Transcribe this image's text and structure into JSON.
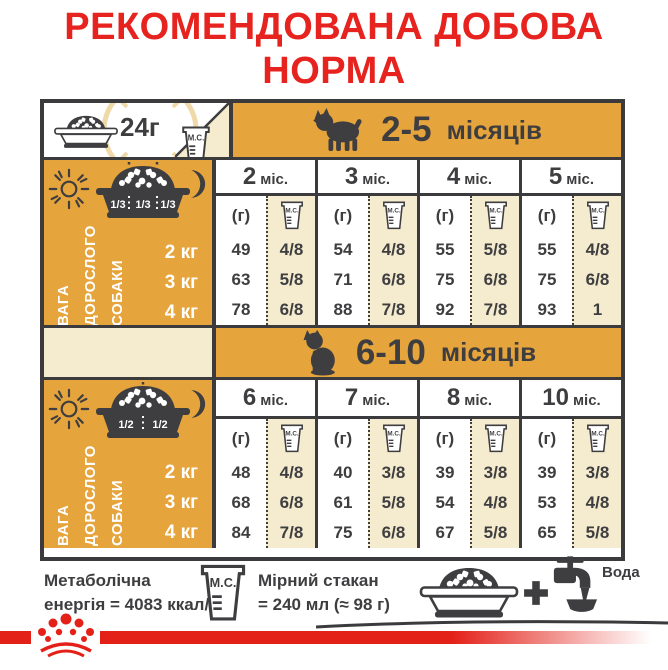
{
  "title": {
    "line1": "РЕКОМЕНДОВАНА ДОБОВА",
    "line2": "НОРМА"
  },
  "daily_amount": "24г",
  "labels": {
    "grams": "(г)",
    "cup_abbr": "М.С.",
    "water": "Вода",
    "plus": "+"
  },
  "sidebar": {
    "weight_lines": [
      "ВАГА",
      "ДОРОСЛОГО",
      "СОБАКИ"
    ],
    "weights": [
      "2 кг",
      "3 кг",
      "4 кг"
    ]
  },
  "sections": [
    {
      "range": "2-5",
      "range_unit": "місяців",
      "portions": [
        "1/3",
        "1/3",
        "1/3"
      ],
      "columns": [
        {
          "num": "2",
          "suffix": "міс.",
          "grams": [
            "49",
            "63",
            "78"
          ],
          "cups": [
            "4/8",
            "5/8",
            "6/8"
          ]
        },
        {
          "num": "3",
          "suffix": "міс.",
          "grams": [
            "54",
            "71",
            "88"
          ],
          "cups": [
            "4/8",
            "6/8",
            "7/8"
          ]
        },
        {
          "num": "4",
          "suffix": "міс.",
          "grams": [
            "55",
            "75",
            "92"
          ],
          "cups": [
            "5/8",
            "6/8",
            "7/8"
          ]
        },
        {
          "num": "5",
          "suffix": "міс.",
          "grams": [
            "55",
            "75",
            "93"
          ],
          "cups": [
            "4/8",
            "6/8",
            "1"
          ]
        }
      ]
    },
    {
      "range": "6-10",
      "range_unit": "місяців",
      "portions": [
        "1/2",
        "1/2"
      ],
      "columns": [
        {
          "num": "6",
          "suffix": "міс.",
          "grams": [
            "48",
            "68",
            "84"
          ],
          "cups": [
            "4/8",
            "6/8",
            "7/8"
          ]
        },
        {
          "num": "7",
          "suffix": "міс.",
          "grams": [
            "40",
            "61",
            "75"
          ],
          "cups": [
            "3/8",
            "5/8",
            "6/8"
          ]
        },
        {
          "num": "8",
          "suffix": "міс.",
          "grams": [
            "39",
            "54",
            "67"
          ],
          "cups": [
            "3/8",
            "4/8",
            "5/8"
          ]
        },
        {
          "num": "10",
          "suffix": "міс.",
          "grams": [
            "39",
            "53",
            "65"
          ],
          "cups": [
            "3/8",
            "4/8",
            "5/8"
          ]
        }
      ]
    }
  ],
  "footer": {
    "metabolic_line1": "Метаболічна",
    "metabolic_line2": "енергія = 4083 ккал/кг",
    "cup_line1": "Мірний стакан",
    "cup_line2": "= 240 мл (≈ 98 г)"
  },
  "icons": {
    "bowl": "dog-bowl-icon",
    "cup": "measuring-cup-icon",
    "sun": "day-icon",
    "moon": "night-icon",
    "dog_puppy": "puppy-silhouette-icon",
    "dog_junior": "young-dog-silhouette-icon",
    "clock": "24h-clock-icon",
    "tap": "water-tap-icon",
    "plus": "plus-icon",
    "crown": "royal-canin-crown-logo"
  },
  "colors": {
    "accent_orange": "#E6A43C",
    "beige": "#F5EBCE",
    "ink": "#3E3E40",
    "brand_red": "#E6231E",
    "strip_red": "#E32119",
    "clock_pale": "#EFD9A8"
  }
}
